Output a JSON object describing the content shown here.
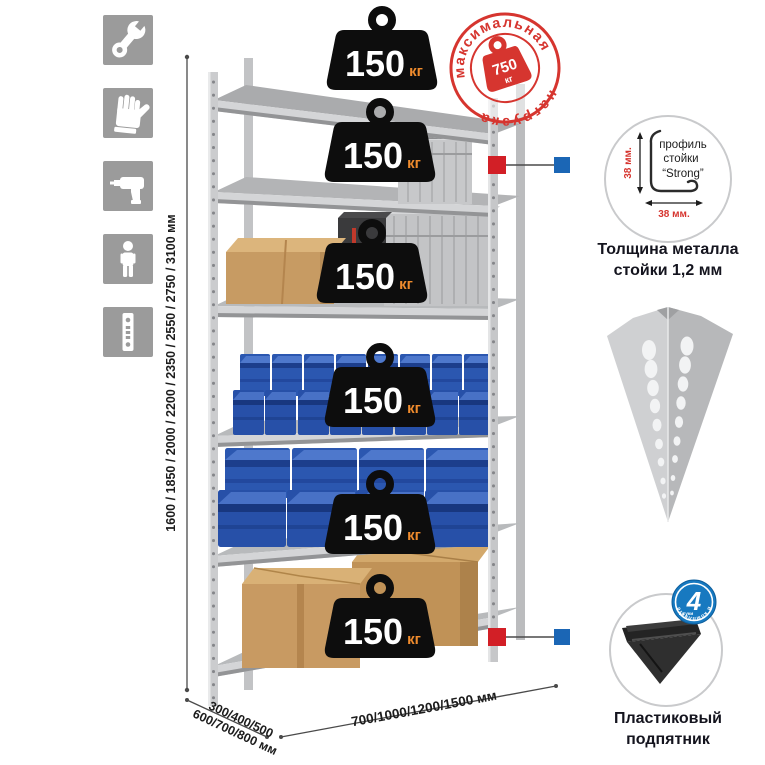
{
  "assembly_icons": {
    "items": [
      {
        "name": "wrench-icon"
      },
      {
        "name": "gloves-icon"
      },
      {
        "name": "drill-icon"
      },
      {
        "name": "person-icon"
      },
      {
        "name": "upright-profile-icon"
      }
    ]
  },
  "dimensions": {
    "height_options": "1600 / 1850 / 2000 / 2200 / 2350 / 2550 / 2750 / 3100 мм",
    "depth_options_line1": "300/400/500",
    "depth_options_line2": "600/700/800 мм",
    "width_options": "700/1000/1200/1500 мм"
  },
  "shelves": {
    "count": 6,
    "weights": [
      {
        "value": "150",
        "unit": "кг"
      },
      {
        "value": "150",
        "unit": "кг"
      },
      {
        "value": "150",
        "unit": "кг"
      },
      {
        "value": "150",
        "unit": "кг"
      },
      {
        "value": "150",
        "unit": "кг"
      },
      {
        "value": "150",
        "unit": "кг"
      }
    ]
  },
  "max_load_stamp": {
    "top_arc": "максимальная",
    "bottom_arc": "нагрузка",
    "value": "750",
    "unit": "кг"
  },
  "profile_callout": {
    "line1": "профиль",
    "line2": "стойки",
    "line3": "“Strong”",
    "vertical_dim": "38 мм.",
    "horizontal_dim": "38 мм.",
    "caption_line1": "Толщина металла",
    "caption_line2": "стойки 1,2 мм"
  },
  "foot_callout": {
    "badge_number": "4",
    "badge_small_text": "штуки",
    "badge_arc_text": "в комплекте",
    "caption_line1": "Пластиковый",
    "caption_line2": "подпятник"
  },
  "colors": {
    "stamp_red": "#d6352f",
    "marker_red": "#d21f26",
    "marker_blue": "#1b66b5",
    "badge_blue": "#1779c0",
    "weight_black": "#0d0d0d",
    "weight_unit_orange": "#ef8b2d",
    "icon_gray": "#9b9b9b",
    "metal_light": "#d2d3d5",
    "bin_blue": "#2b57b0",
    "cardboard_tan": "#c89a62"
  }
}
